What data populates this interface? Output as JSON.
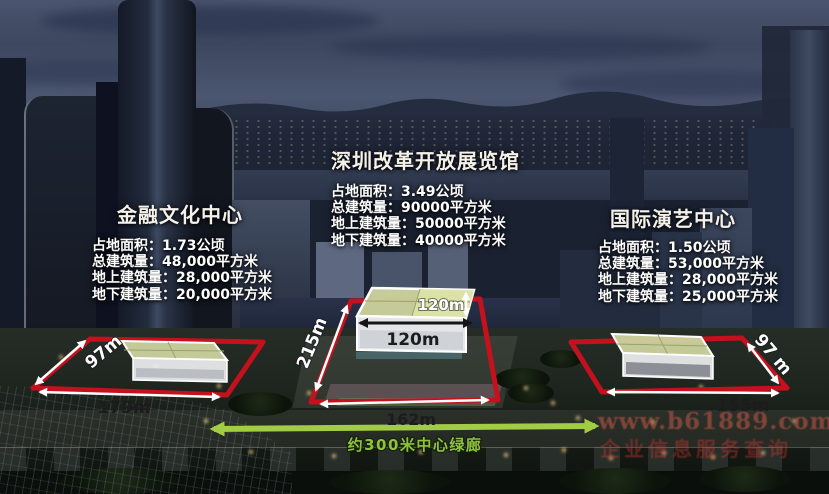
{
  "projects": [
    {
      "name": "financial-culture-center",
      "title": "金融文化中心",
      "lines": [
        "占地面积：1.73公顷",
        "总建筑量：48,000平方米",
        "地上建筑量：28,000平方米",
        "地下建筑量：20,000平方米"
      ],
      "dims": {
        "side": "97m",
        "front": "179m"
      }
    },
    {
      "name": "shenzhen-reform-opening-exhibition-hall",
      "title": "深圳改革开放展览馆",
      "lines": [
        "占地面积：3.49公顷",
        "总建筑量：90000平方米",
        "地上建筑量：50000平方米",
        "地下建筑量：40000平方米"
      ],
      "dims": {
        "depth": "215m",
        "front": "162m",
        "building_width": "120m",
        "building_depth": "120m"
      }
    },
    {
      "name": "international-performing-arts-center",
      "title": "国际演艺中心",
      "lines": [
        "占地面积：1.50公顷",
        "总建筑量：53,000平方米",
        "地上建筑量：28,000平方米",
        "地下建筑量：25,000平方米"
      ],
      "dims": {
        "side": "97 m",
        "front": "155m"
      }
    }
  ],
  "corridor": {
    "label": "约300米中心绿廊"
  },
  "watermark": {
    "line1": "www.b61889.com",
    "line2": "企业信息服务查询"
  },
  "colors": {
    "site_outline_red": "#c5111e",
    "corridor_green": "#8fc23c",
    "dim_text_light": "#ffffff",
    "dim_text_dark": "#1c1c1c",
    "proposed_roof": "#ccd39e"
  }
}
